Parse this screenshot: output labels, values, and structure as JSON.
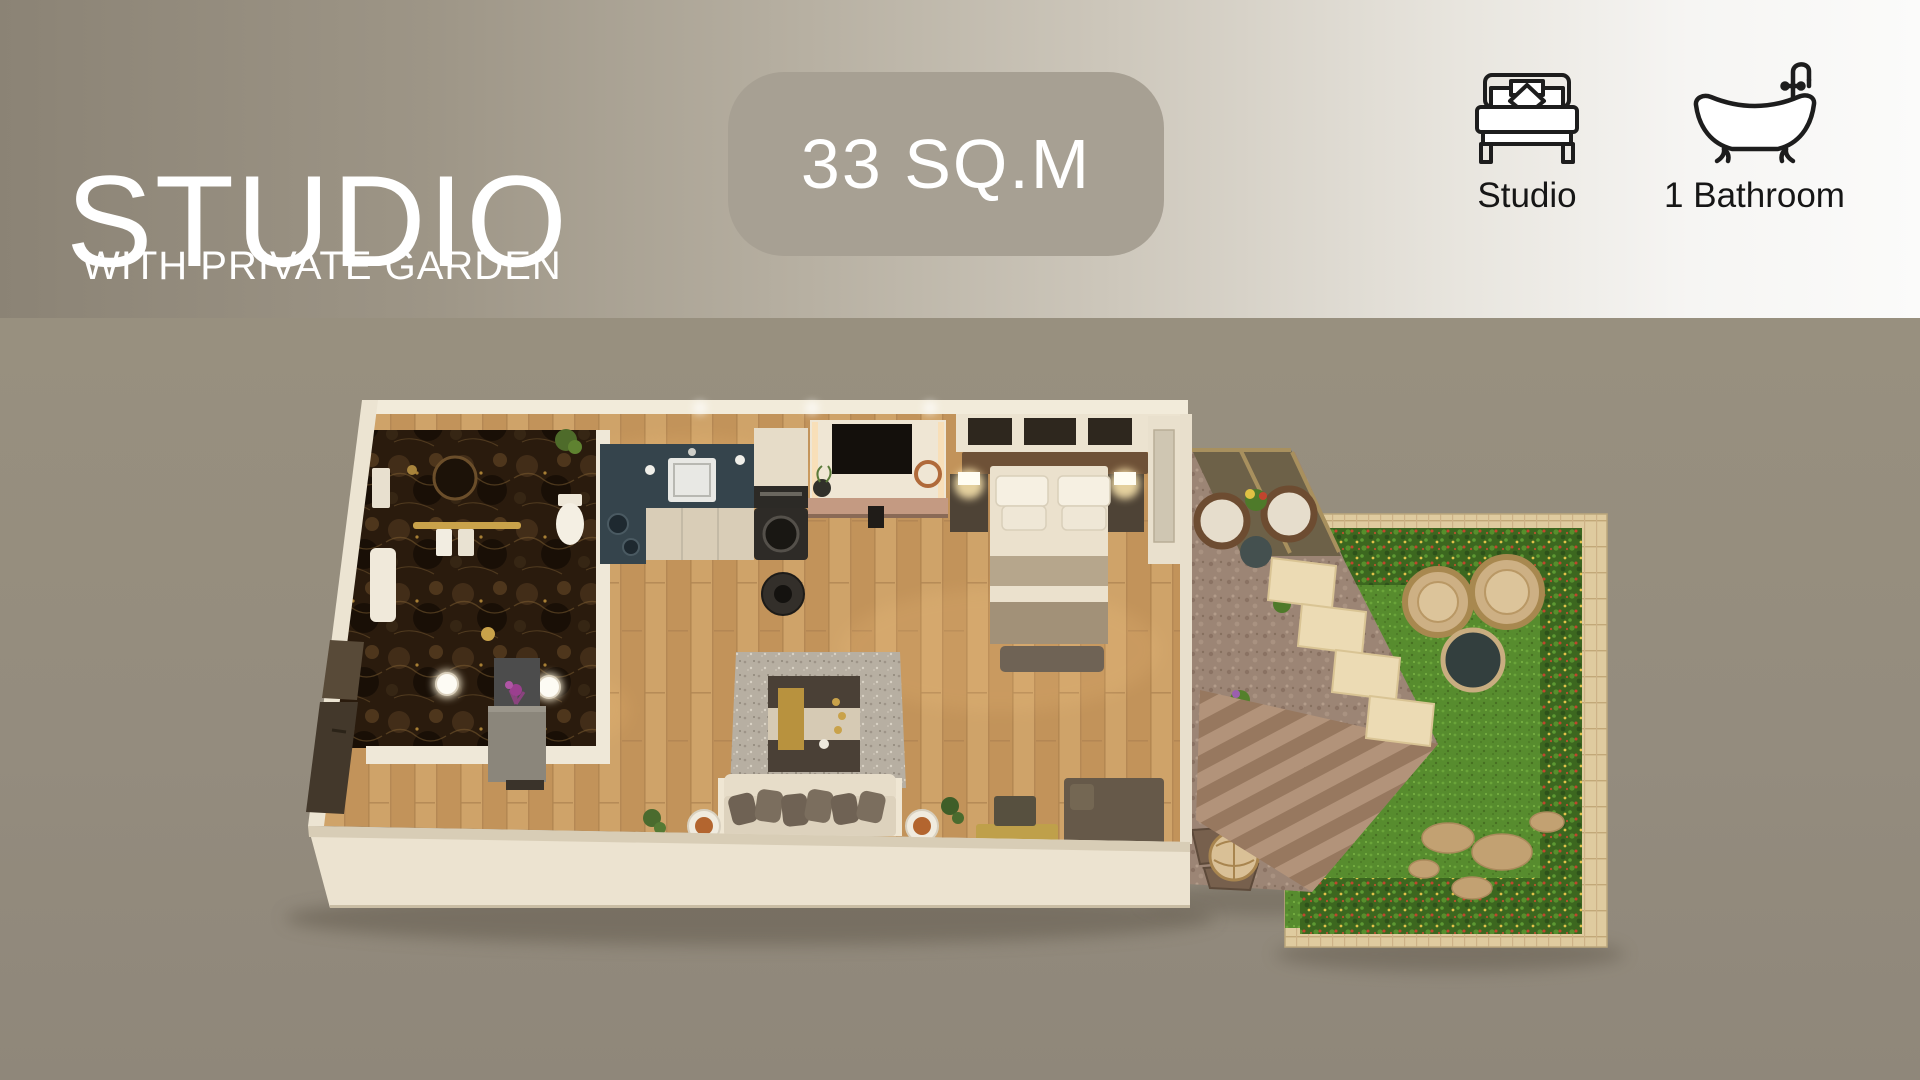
{
  "header": {
    "title": "STUDIO",
    "subtitle": "WITH PRIVATE GARDEN",
    "area_badge": "33 SQ.M",
    "features": [
      {
        "icon": "bed-icon",
        "label": "Studio"
      },
      {
        "icon": "bathtub-icon",
        "label": "1 Bathroom"
      }
    ]
  },
  "colors": {
    "header_gradient_left": "#8b8375",
    "header_gradient_right": "#fbfbfa",
    "badge_background": "#a7a093",
    "title_text": "#ffffff",
    "feature_text": "#161616",
    "body_background": "#948c7e",
    "wall_cream": "#ece3d0",
    "floor_wood": "#c99c63",
    "kitchen_counter": "#35444c",
    "bathroom_marble": "#2a1b0d",
    "garden_grass": "#578c2e",
    "hedge_green": "#3c671f",
    "terrace_stone": "#9c8575"
  },
  "floor_plan": {
    "view": "isometric-3d-top-down-render",
    "rooms": [
      "bathroom",
      "entry",
      "kitchen",
      "tv-wall",
      "bedroom-area",
      "living-area",
      "terrace",
      "staircase",
      "private-garden"
    ]
  }
}
